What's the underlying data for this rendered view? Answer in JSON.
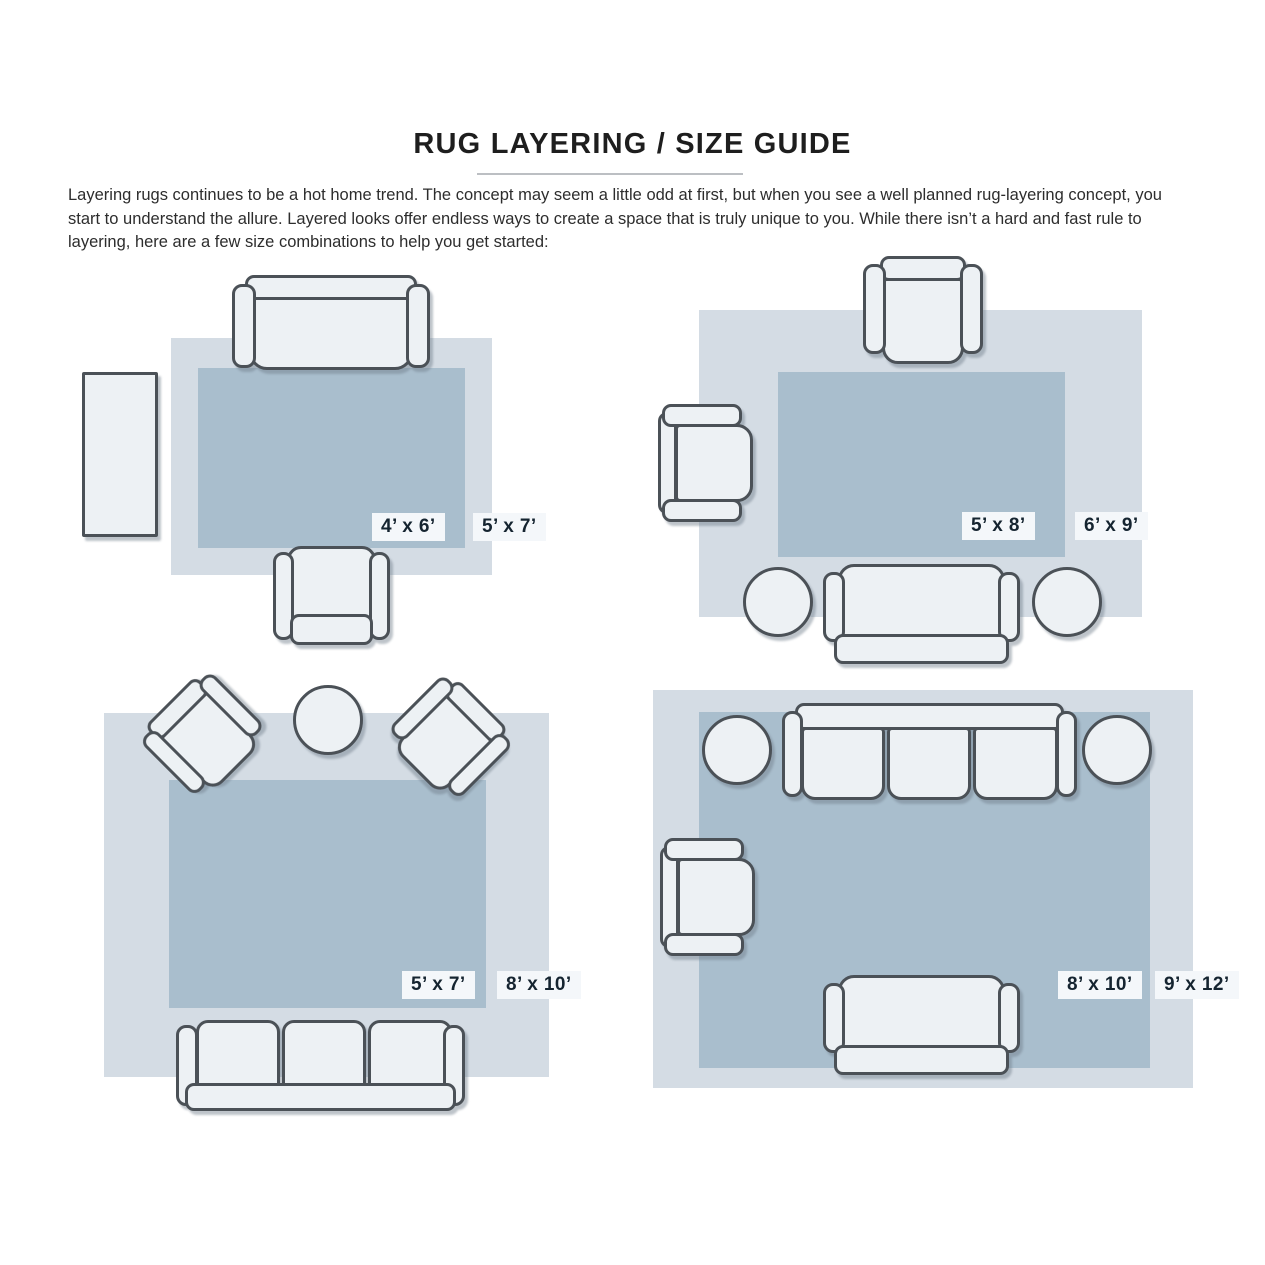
{
  "title": "RUG LAYERING / SIZE GUIDE",
  "intro": "Layering rugs continues to be a hot home trend. The concept may seem a little odd at first, but when you see a well planned rug-layering concept, you start to understand the allure. Layered looks offer endless ways to create a space that is truly unique to you. While there isn’t a hard and fast rule to layering, here are a few size combinations to help you get started:",
  "colors": {
    "rug_light": "#d4dce4",
    "rug_dark": "#a9becd",
    "furniture_fill": "#edf1f4",
    "outline": "#4b5157",
    "label_bg": "#f4f7fa",
    "label_text": "#152430"
  },
  "layouts": [
    {
      "name": "top-left",
      "outer_rug": {
        "label": "5’ x 7’",
        "x": 171,
        "y": 338,
        "w": 321,
        "h": 237
      },
      "inner_rug": {
        "label": "4’ x 6’",
        "x": 198,
        "y": 368,
        "w": 267,
        "h": 180
      },
      "inner_label_pos": {
        "x": 372,
        "y": 513
      },
      "outer_label_pos": {
        "x": 473,
        "y": 513
      },
      "furniture": [
        {
          "kind": "sidetable",
          "name": "side-table",
          "x": 82,
          "y": 372
        },
        {
          "kind": "sofa2down",
          "name": "sofa",
          "x": 232,
          "y": 275
        },
        {
          "kind": "chairup",
          "name": "armchair",
          "x": 273,
          "y": 546
        }
      ]
    },
    {
      "name": "top-right",
      "outer_rug": {
        "label": "6’ x 9’",
        "x": 699,
        "y": 310,
        "w": 443,
        "h": 307
      },
      "inner_rug": {
        "label": "5’ x 8’",
        "x": 778,
        "y": 372,
        "w": 287,
        "h": 185
      },
      "inner_label_pos": {
        "x": 962,
        "y": 512
      },
      "outer_label_pos": {
        "x": 1075,
        "y": 512
      },
      "furniture": [
        {
          "kind": "chairdown",
          "name": "armchair",
          "x": 863,
          "y": 256
        },
        {
          "kind": "chairright",
          "name": "armchair",
          "x": 658,
          "y": 404
        },
        {
          "kind": "loveseatup",
          "name": "loveseat",
          "x": 823,
          "y": 564
        },
        {
          "kind": "ottoman",
          "name": "ottoman",
          "x": 743,
          "y": 567
        },
        {
          "kind": "ottoman",
          "name": "ottoman",
          "x": 1032,
          "y": 567
        }
      ]
    },
    {
      "name": "bottom-left",
      "outer_rug": {
        "label": "8’ x 10’",
        "x": 104,
        "y": 713,
        "w": 445,
        "h": 364
      },
      "inner_rug": {
        "label": "5’ x 7’",
        "x": 169,
        "y": 780,
        "w": 317,
        "h": 228
      },
      "inner_label_pos": {
        "x": 402,
        "y": 971
      },
      "outer_label_pos": {
        "x": 497,
        "y": 971
      },
      "furniture": [
        {
          "kind": "chairdownS",
          "name": "armchair-angled",
          "x": 154,
          "y": 687,
          "rot": -45
        },
        {
          "kind": "chairdownS",
          "name": "armchair-angled",
          "x": 399,
          "y": 690,
          "rot": 45
        },
        {
          "kind": "roundtable",
          "name": "round-table",
          "x": 293,
          "y": 685
        },
        {
          "kind": "sofa3up",
          "name": "sofa",
          "x": 176,
          "y": 1020
        }
      ]
    },
    {
      "name": "bottom-right",
      "outer_rug": {
        "label": "9’ x 12’",
        "x": 653,
        "y": 690,
        "w": 540,
        "h": 398
      },
      "inner_rug": {
        "label": "8’ x 10’",
        "x": 699,
        "y": 712,
        "w": 451,
        "h": 356
      },
      "inner_label_pos": {
        "x": 1058,
        "y": 971
      },
      "outer_label_pos": {
        "x": 1155,
        "y": 971
      },
      "furniture": [
        {
          "kind": "sofa3down",
          "name": "sofa",
          "x": 782,
          "y": 703
        },
        {
          "kind": "ottoman",
          "name": "ottoman",
          "x": 702,
          "y": 715
        },
        {
          "kind": "ottoman",
          "name": "ottoman",
          "x": 1082,
          "y": 715
        },
        {
          "kind": "chairright",
          "name": "armchair",
          "x": 660,
          "y": 838
        },
        {
          "kind": "loveseatup",
          "name": "loveseat",
          "x": 823,
          "y": 975
        }
      ]
    }
  ]
}
